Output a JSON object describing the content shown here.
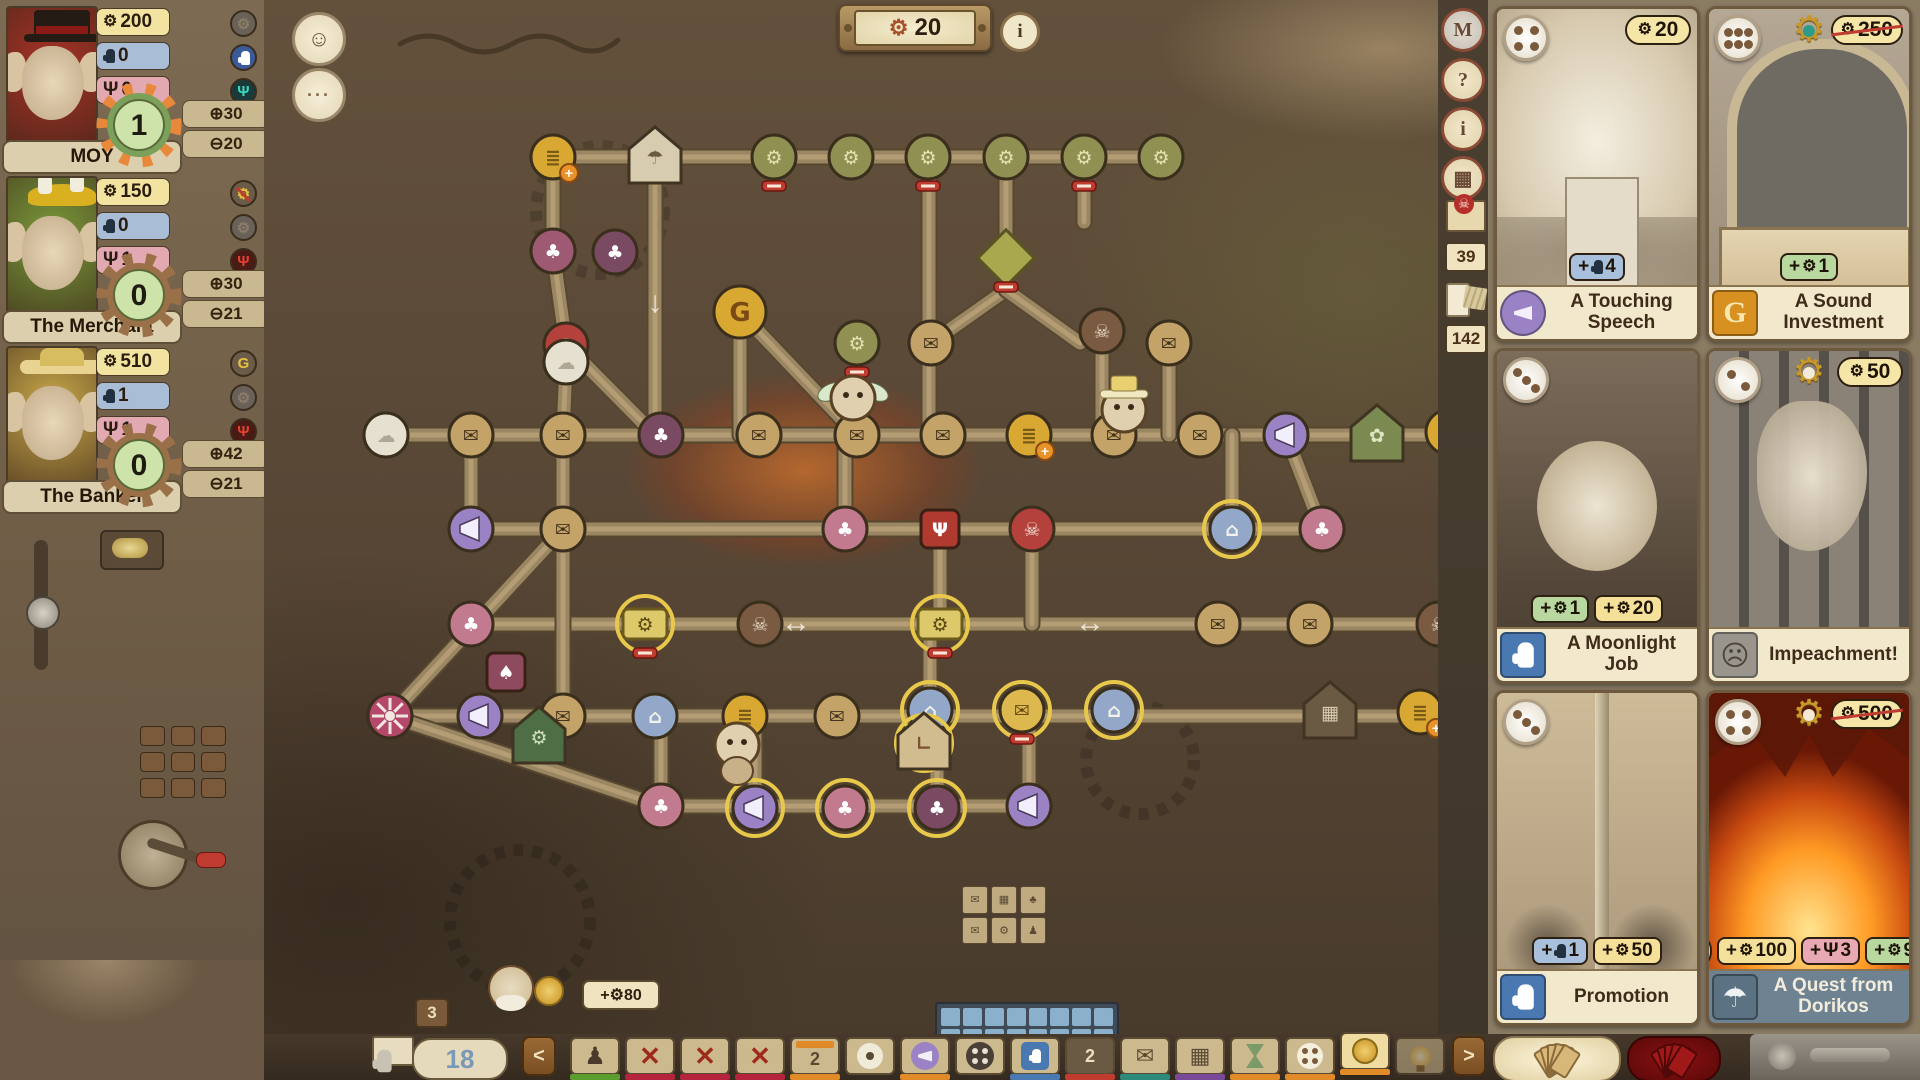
{
  "hud": {
    "gear_counter": "20",
    "info_label": "i",
    "avatar_icon": "☺",
    "chat_icon": "···"
  },
  "players": [
    {
      "name": "MOY",
      "coins": "200",
      "hands": "0",
      "psi": "0",
      "score": "1",
      "gain": "⊕30",
      "loss": "⊖20",
      "gear_style": "orange",
      "portrait_bg": "#a83226",
      "hat_color": "#2a2018",
      "tokens": {
        "gear": "dim",
        "hand": "blue",
        "psi": "teal"
      }
    },
    {
      "name": "The Merchant",
      "coins": "150",
      "hands": "0",
      "psi": "1",
      "score": "0",
      "gain": "⊕30",
      "loss": "⊖21",
      "gear_style": "brown",
      "portrait_bg": "#7a9a3a",
      "hat_color": "#d8b020",
      "tokens": {
        "gear": "gold-slash",
        "hand": "dim",
        "psi": "red"
      }
    },
    {
      "name": "The Banker",
      "coins": "510",
      "hands": "1",
      "psi": "1",
      "score": "0",
      "gain": "⊕42",
      "loss": "⊖21",
      "gear_style": "brown",
      "portrait_bg": "#c8a84a",
      "hat_color": "#e8d490",
      "tokens": {
        "gear": "gold",
        "hand": "dim",
        "psi": "red"
      }
    }
  ],
  "side_tools": {
    "buttons": [
      {
        "label": "M"
      },
      {
        "label": "?"
      },
      {
        "label": "i"
      },
      {
        "label": "▦"
      }
    ],
    "mail_count": "39",
    "deck_count": "142"
  },
  "cards": [
    {
      "name": "A Touching Speech",
      "cost": "20",
      "cost_struck": false,
      "pips": 4,
      "gear_badge": "none",
      "category": "megaphone",
      "art": "speech",
      "rewards": [
        {
          "icon": "hand",
          "amount": "4",
          "color": "blue"
        }
      ]
    },
    {
      "name": "A Sound Investment",
      "cost": "250",
      "cost_struck": true,
      "pips": 6,
      "gear_badge": "teal",
      "category": "money",
      "art": "invest",
      "rewards": [
        {
          "icon": "gear",
          "amount": "1",
          "color": "green"
        }
      ]
    },
    {
      "name": "A Moonlight Job",
      "cost": "",
      "cost_struck": false,
      "pips": 3,
      "gear_badge": "none",
      "category": "hand",
      "art": "moon",
      "rewards": [
        {
          "icon": "gear",
          "amount": "1",
          "color": "green"
        },
        {
          "icon": "coin",
          "amount": "20",
          "color": "yellow"
        }
      ]
    },
    {
      "name": "Impeachment!",
      "cost": "50",
      "cost_struck": false,
      "pips": 2,
      "gear_badge": "outline",
      "category": "goblin",
      "art": "impeach",
      "rewards": []
    },
    {
      "name": "Promotion",
      "cost": "",
      "cost_struck": false,
      "pips": 3,
      "gear_badge": "none",
      "category": "hand",
      "art": "promo",
      "rewards": [
        {
          "icon": "hand",
          "amount": "1",
          "color": "blue"
        },
        {
          "icon": "coin",
          "amount": "50",
          "color": "yellow"
        }
      ]
    },
    {
      "name": "A Quest from Dorikos",
      "cost": "500",
      "cost_struck": true,
      "pips": 4,
      "gear_badge": "outline",
      "category": "parachute",
      "art": "quest",
      "title_style": "dark",
      "rewards": [
        {
          "icon": "bulb",
          "amount": "",
          "color": "chip"
        },
        {
          "icon": "coin",
          "amount": "100",
          "color": "yellow"
        },
        {
          "icon": "psi",
          "amount": "3",
          "color": "pink"
        },
        {
          "icon": "gear",
          "amount": "9",
          "color": "green"
        }
      ]
    }
  ],
  "bottom_bar": {
    "hand_count": "18",
    "back": "<",
    "forward": ">",
    "tiles": [
      {
        "k": "figure",
        "u": "green"
      },
      {
        "k": "x",
        "u": "crimson"
      },
      {
        "k": "x",
        "u": "crimson"
      },
      {
        "k": "x",
        "u": "crimson"
      },
      {
        "k": "cal",
        "n": "2",
        "u": "orange"
      },
      {
        "k": "circle-dot",
        "u": "none"
      },
      {
        "k": "megaphone",
        "u": "orange"
      },
      {
        "k": "dots",
        "u": "none"
      },
      {
        "k": "hand",
        "u": "blue"
      },
      {
        "k": "num",
        "n": "2",
        "u": "red"
      },
      {
        "k": "envelope",
        "u": "teal"
      },
      {
        "k": "grid",
        "u": "purple"
      },
      {
        "k": "hourglass",
        "u": "orange"
      },
      {
        "k": "fourdots",
        "u": "orange"
      },
      {
        "k": "coin",
        "u": "orange",
        "hl": true
      },
      {
        "k": "bulb",
        "u": "none",
        "dim": true
      }
    ]
  },
  "board": {
    "counters": {
      "bonus": "+⚙80",
      "stack": "3"
    },
    "arrows": [
      {
        "x": 796,
        "y": 632,
        "g": "↔"
      },
      {
        "x": 1090,
        "y": 632,
        "g": "↔"
      },
      {
        "x": 655,
        "y": 312,
        "g": "↓"
      }
    ],
    "beams": [
      [
        540,
        157,
        1168,
        157
      ],
      [
        386,
        435,
        1452,
        435
      ],
      [
        466,
        529,
        1326,
        529
      ],
      [
        466,
        624,
        1444,
        624
      ],
      [
        386,
        716,
        1424,
        716
      ],
      [
        655,
        806,
        1035,
        806
      ],
      [
        553,
        157,
        553,
        251
      ],
      [
        655,
        157,
        655,
        435
      ],
      [
        929,
        157,
        929,
        435
      ],
      [
        1006,
        157,
        1006,
        290
      ],
      [
        1084,
        157,
        1084,
        222
      ],
      [
        740,
        312,
        740,
        435
      ],
      [
        553,
        251,
        566,
        345
      ],
      [
        566,
        345,
        655,
        435
      ],
      [
        740,
        312,
        857,
        435
      ],
      [
        1006,
        290,
        931,
        343
      ],
      [
        1006,
        290,
        1080,
        343
      ],
      [
        1102,
        331,
        1102,
        435
      ],
      [
        1169,
        343,
        1169,
        435
      ],
      [
        845,
        435,
        845,
        529
      ],
      [
        1232,
        435,
        1232,
        529
      ],
      [
        1286,
        435,
        1322,
        529
      ],
      [
        471,
        435,
        471,
        529
      ],
      [
        563,
        435,
        563,
        716
      ],
      [
        940,
        529,
        940,
        624
      ],
      [
        1032,
        529,
        1032,
        624
      ],
      [
        930,
        624,
        930,
        716
      ],
      [
        661,
        716,
        661,
        806
      ],
      [
        755,
        716,
        755,
        808
      ],
      [
        937,
        716,
        937,
        808
      ],
      [
        1029,
        716,
        1029,
        806
      ],
      [
        390,
        716,
        563,
        529
      ],
      [
        390,
        716,
        661,
        806
      ],
      [
        566,
        362,
        563,
        435
      ]
    ],
    "nodes": [
      [
        "coin",
        553,
        157,
        "p"
      ],
      [
        "house-parachute",
        655,
        157,
        ""
      ],
      [
        "gmoney",
        774,
        157,
        "m"
      ],
      [
        "gmoney",
        851,
        157,
        ""
      ],
      [
        "gmoney",
        928,
        157,
        "m"
      ],
      [
        "gmoney",
        1006,
        157,
        ""
      ],
      [
        "gmoney",
        1084,
        157,
        "m"
      ],
      [
        "gmoney",
        1161,
        157,
        ""
      ],
      [
        "club-maroon",
        553,
        251,
        ""
      ],
      [
        "skull-red",
        566,
        345,
        ""
      ],
      [
        "club-dark",
        615,
        252,
        ""
      ],
      [
        "gear-g",
        740,
        312,
        ""
      ],
      [
        "gmoney",
        857,
        343,
        "m"
      ],
      [
        "diamond",
        1006,
        258,
        "m"
      ],
      [
        "envelope",
        931,
        343,
        ""
      ],
      [
        "skull-brown",
        1102,
        331,
        ""
      ],
      [
        "envelope",
        1169,
        343,
        ""
      ],
      [
        "white-puff",
        386,
        435,
        ""
      ],
      [
        "white-puff",
        566,
        362,
        ""
      ],
      [
        "envelope",
        471,
        435,
        ""
      ],
      [
        "envelope",
        563,
        435,
        ""
      ],
      [
        "club-dark",
        661,
        435,
        ""
      ],
      [
        "envelope",
        759,
        435,
        ""
      ],
      [
        "envelope",
        857,
        435,
        ""
      ],
      [
        "envelope",
        943,
        435,
        ""
      ],
      [
        "coin",
        1029,
        435,
        "p"
      ],
      [
        "envelope",
        1114,
        435,
        ""
      ],
      [
        "envelope",
        1200,
        435,
        ""
      ],
      [
        "megaphone",
        1286,
        435,
        ""
      ],
      [
        "house-leaf",
        1377,
        435,
        ""
      ],
      [
        "coin",
        1448,
        432,
        "p"
      ],
      [
        "megaphone",
        471,
        529,
        ""
      ],
      [
        "envelope",
        563,
        529,
        ""
      ],
      [
        "club-pink",
        845,
        529,
        ""
      ],
      [
        "psi-tile",
        940,
        529,
        ""
      ],
      [
        "skull-red",
        1032,
        529,
        ""
      ],
      [
        "lantern",
        1232,
        529,
        "r"
      ],
      [
        "club-pink",
        1322,
        529,
        ""
      ],
      [
        "club-pink",
        471,
        624,
        ""
      ],
      [
        "spade-tile",
        506,
        672,
        ""
      ],
      [
        "money",
        645,
        624,
        "rm"
      ],
      [
        "skull-brown",
        760,
        624,
        ""
      ],
      [
        "money",
        940,
        624,
        "rm"
      ],
      [
        "envelope",
        1218,
        624,
        ""
      ],
      [
        "envelope",
        1310,
        624,
        ""
      ],
      [
        "skull-brown",
        1439,
        624,
        ""
      ],
      [
        "wheel",
        390,
        716,
        ""
      ],
      [
        "megaphone",
        480,
        716,
        ""
      ],
      [
        "envelope",
        563,
        716,
        ""
      ],
      [
        "lantern",
        655,
        716,
        ""
      ],
      [
        "coin",
        745,
        716,
        ""
      ],
      [
        "envelope",
        837,
        716,
        ""
      ],
      [
        "lantern",
        930,
        710,
        "r"
      ],
      [
        "envelope-gold",
        1022,
        710,
        "rm"
      ],
      [
        "lantern",
        1114,
        710,
        "r"
      ],
      [
        "house-grid",
        1330,
        712,
        ""
      ],
      [
        "coin",
        1420,
        712,
        "p"
      ],
      [
        "club-pink",
        661,
        806,
        ""
      ],
      [
        "megaphone",
        755,
        808,
        "r"
      ],
      [
        "club-pink",
        845,
        808,
        "r"
      ],
      [
        "club-dark",
        937,
        808,
        "r"
      ],
      [
        "megaphone",
        1029,
        806,
        ""
      ],
      [
        "house-gear",
        539,
        737,
        ""
      ],
      [
        "house-boot",
        924,
        743,
        "r"
      ]
    ],
    "characters": [
      {
        "kind": "winged",
        "x": 853,
        "y": 398
      },
      {
        "kind": "hat",
        "x": 1124,
        "y": 410
      },
      {
        "kind": "small",
        "x": 737,
        "y": 745
      }
    ]
  }
}
